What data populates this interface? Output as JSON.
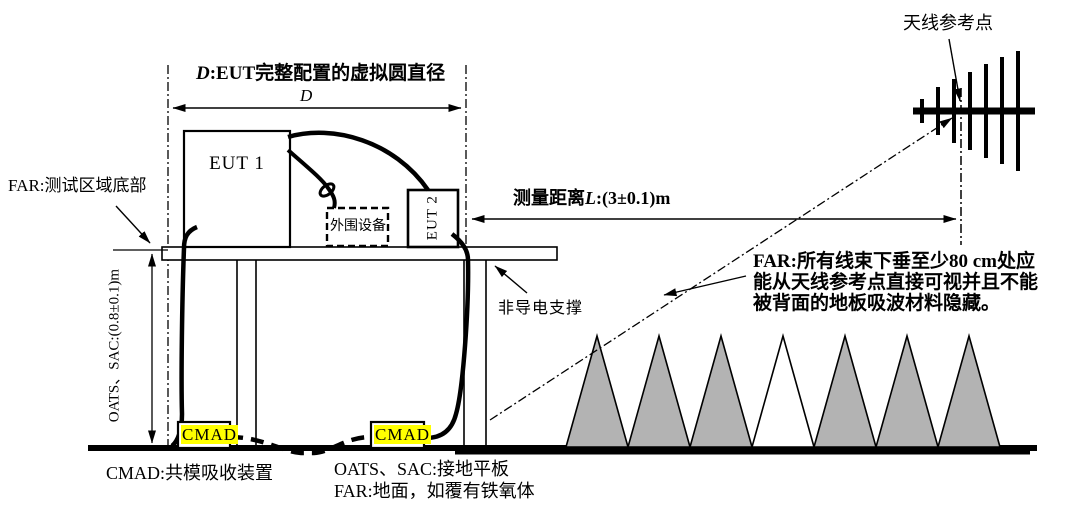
{
  "colors": {
    "highlight": "#ffff00",
    "cone_gray": "#b3b3b3",
    "ink": "#000000",
    "bg": "#ffffff"
  },
  "labels": {
    "d_title_var": "D",
    "d_title_rest": ":EUT完整配置的虚拟圆直径",
    "d_symbol": "D",
    "far_test_area": "FAR:测试区域底部",
    "eut1": "EUT 1",
    "eut2": "EUT 2",
    "peripheral": "外围设备",
    "measure_prefix": "测量距离",
    "measure_var": "L",
    "measure_value": ":(3±0.1)m",
    "antenna_ref_point": "天线参考点",
    "height_oats_sac": "OATS、SAC:(0.8±0.1)m",
    "nonconductive_support": "非导电支撑",
    "far_note": [
      "FAR:所有线束下垂至少80 cm处应",
      "能从天线参考点直接可视并且不能",
      "被背面的地板吸波材料隐藏。"
    ],
    "cmad_left": "CMAD",
    "cmad_right": "CMAD",
    "legend_cmad": "CMAD:共模吸收装置",
    "legend_oats_sac": "OATS、SAC:接地平板",
    "legend_far_ground": "FAR:地面，如覆有铁氧体"
  },
  "absorber": {
    "cone_count": 7,
    "white_cone_index": 4
  }
}
